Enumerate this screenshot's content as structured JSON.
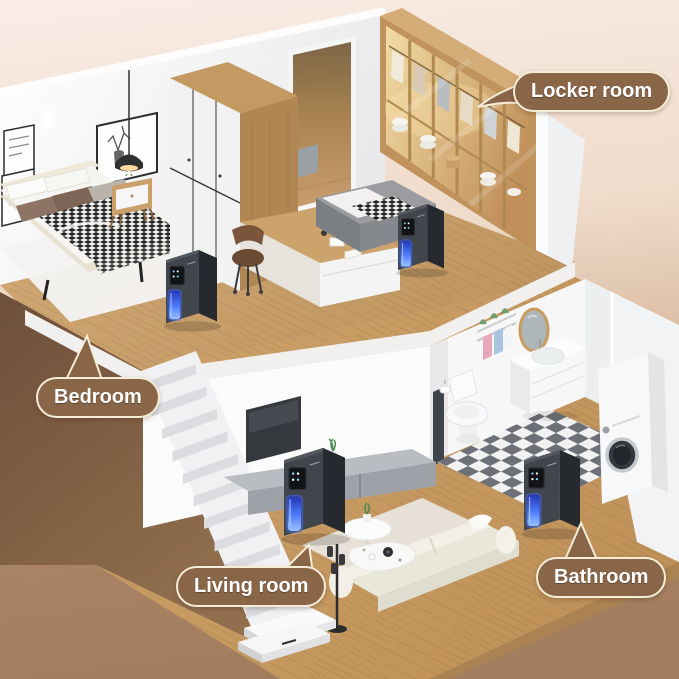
{
  "scene": {
    "description": "3D cutaway illustration of a two-story home showing a dehumidifier placed in four rooms",
    "rooms": [
      "Bedroom",
      "Locker room",
      "Living room",
      "Bathroom"
    ]
  },
  "labels": {
    "locker_room": "Locker room",
    "bedroom": "Bedroom",
    "living_room": "Living room",
    "bathroom": "Bathroom"
  },
  "callout_style": {
    "background": "#8a6648",
    "border": "#f6ecd8",
    "text_color": "#ffffff"
  },
  "product": {
    "name": "dehumidifier",
    "count": 4,
    "body_color": "#3a3e44",
    "glow_color": "#4f7dff"
  },
  "palette": {
    "background_top": "#f9ede6",
    "background_bottom": "#a37e5e",
    "underfloor_brown": "#755540",
    "wood_floor": "#c9a06b",
    "wall_white": "#f7f7f8",
    "checker_dark": "#6d7177",
    "checker_light": "#f2f2f3",
    "locker_light": "#e8c98b"
  }
}
